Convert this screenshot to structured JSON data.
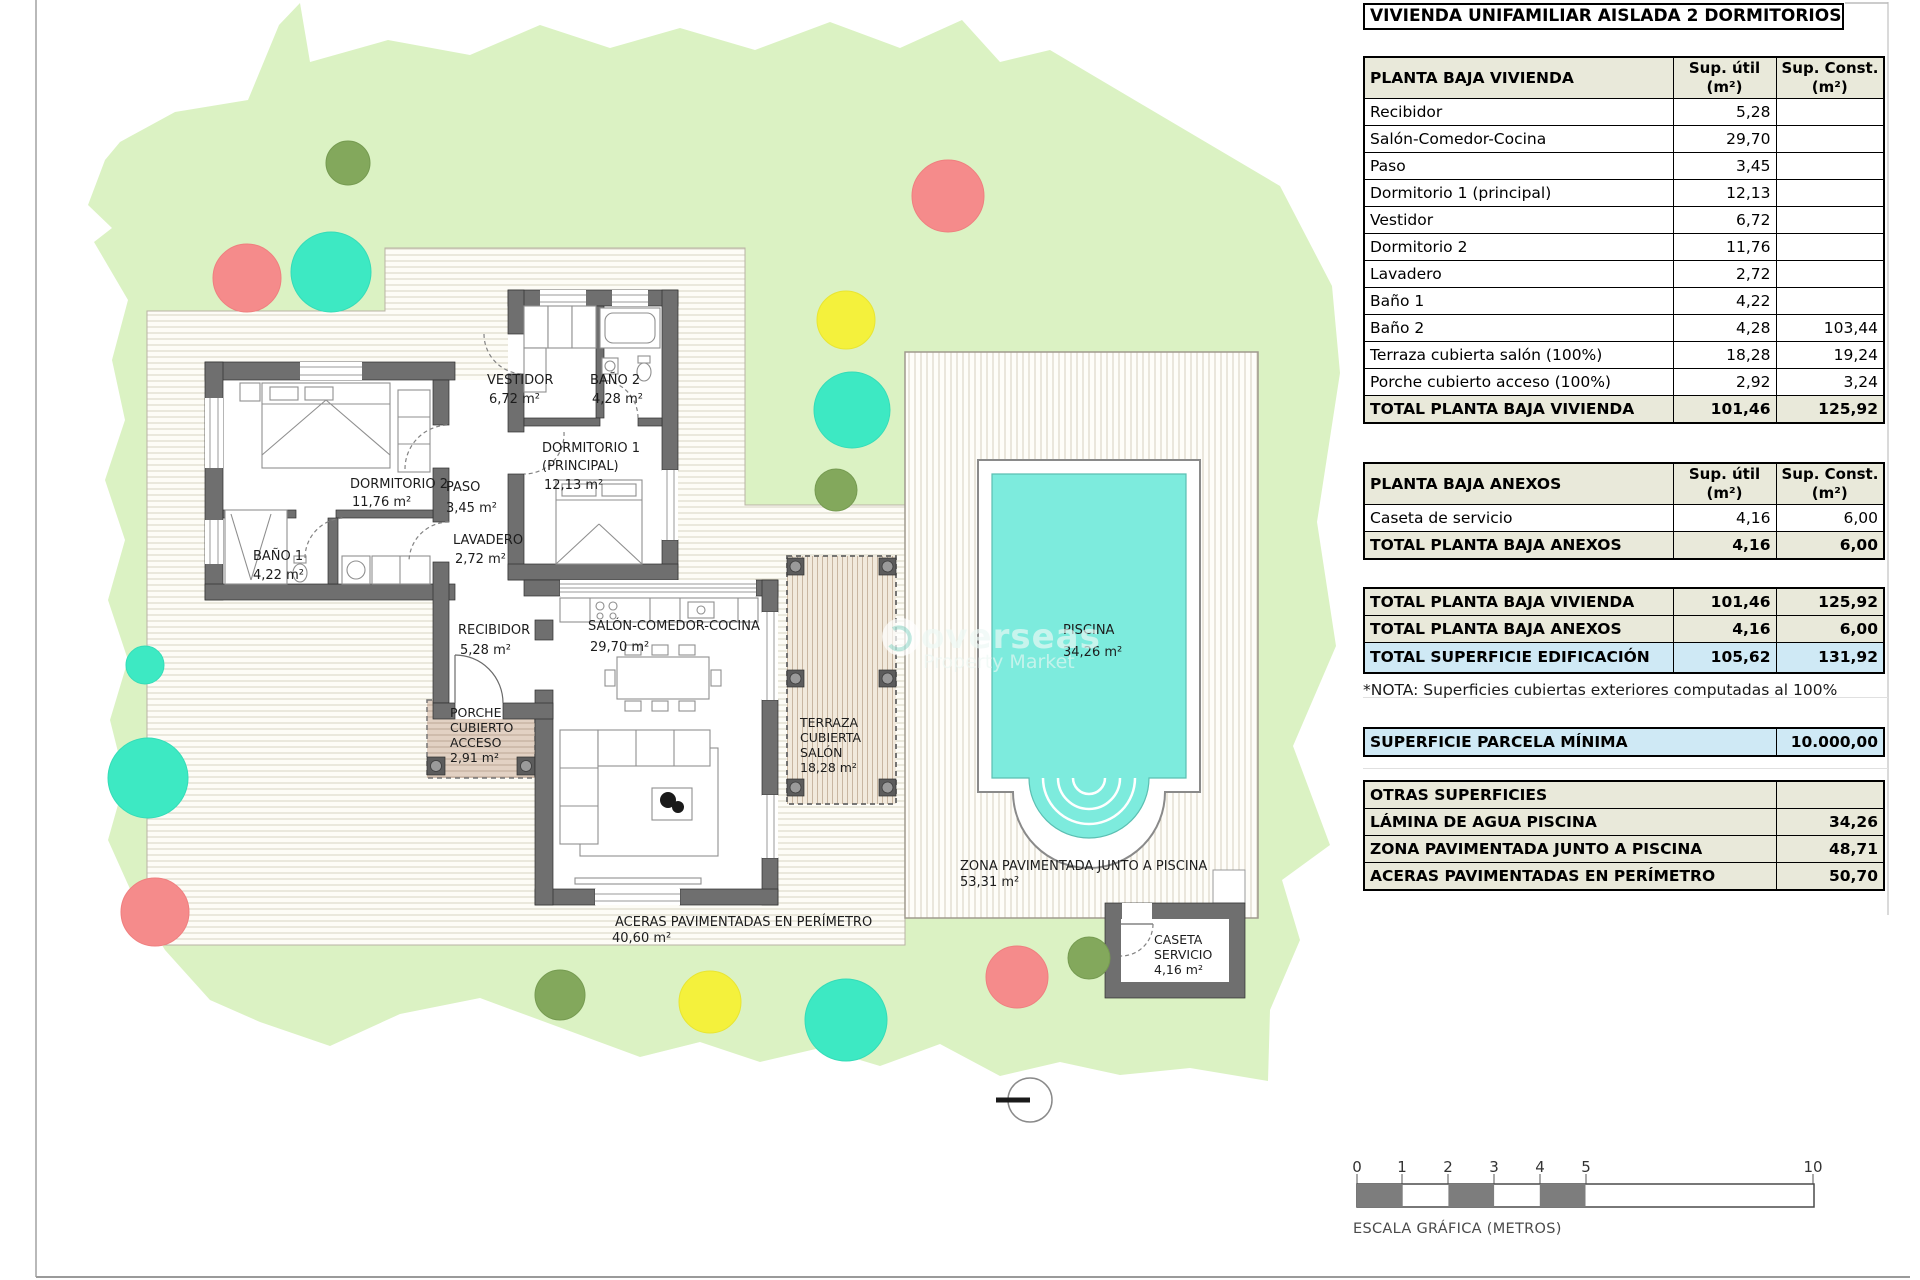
{
  "title": "VIVIENDA UNIFAMILIAR AISLADA 2 DORMITORIOS",
  "columns": {
    "util_1": "Sup. útil",
    "util_2": "(m²)",
    "const_1": "Sup. Const.",
    "const_2": "(m²)"
  },
  "main_table": {
    "header": "PLANTA BAJA VIVIENDA",
    "rows": [
      {
        "label": "Recibidor",
        "util": "5,28",
        "cons": ""
      },
      {
        "label": "Salón-Comedor-Cocina",
        "util": "29,70",
        "cons": ""
      },
      {
        "label": "Paso",
        "util": "3,45",
        "cons": ""
      },
      {
        "label": "Dormitorio 1 (principal)",
        "util": "12,13",
        "cons": ""
      },
      {
        "label": "Vestidor",
        "util": "6,72",
        "cons": ""
      },
      {
        "label": "Dormitorio 2",
        "util": "11,76",
        "cons": ""
      },
      {
        "label": "Lavadero",
        "util": "2,72",
        "cons": ""
      },
      {
        "label": "Baño 1",
        "util": "4,22",
        "cons": ""
      },
      {
        "label": "Baño 2",
        "util": "4,28",
        "cons": "103,44"
      },
      {
        "label": "Terraza cubierta salón (100%)",
        "util": "18,28",
        "cons": "19,24"
      },
      {
        "label": "Porche cubierto acceso (100%)",
        "util": "2,92",
        "cons": "3,24"
      }
    ],
    "total": {
      "label": "TOTAL PLANTA BAJA VIVIENDA",
      "util": "101,46",
      "cons": "125,92"
    }
  },
  "anexos_table": {
    "header": "PLANTA BAJA ANEXOS",
    "rows": [
      {
        "label": "Caseta de servicio",
        "util": "4,16",
        "cons": "6,00"
      }
    ],
    "total": {
      "label": "TOTAL PLANTA BAJA ANEXOS",
      "util": "4,16",
      "cons": "6,00"
    }
  },
  "summary": {
    "rows": [
      {
        "label": "TOTAL PLANTA BAJA VIVIENDA",
        "util": "101,46",
        "cons": "125,92"
      },
      {
        "label": "TOTAL PLANTA BAJA ANEXOS",
        "util": "4,16",
        "cons": "6,00"
      },
      {
        "label": "TOTAL SUPERFICIE EDIFICACIÓN",
        "util": "105,62",
        "cons": "131,92"
      }
    ]
  },
  "nota": "*NOTA: Superficies cubiertas exteriores computadas al 100%",
  "parcela": {
    "label": "SUPERFICIE PARCELA MÍNIMA",
    "value": "10.000,00"
  },
  "otras": {
    "header": "OTRAS SUPERFICIES",
    "rows": [
      {
        "label": "LÁMINA DE AGUA PISCINA",
        "value": "34,26"
      },
      {
        "label": "ZONA PAVIMENTADA JUNTO A PISCINA",
        "value": "48,71"
      },
      {
        "label": "ACERAS PAVIMENTADAS EN PERÍMETRO",
        "value": "50,70"
      }
    ]
  },
  "scale_bar": {
    "ticks": [
      "0",
      "1",
      "2",
      "3",
      "4",
      "5",
      "10"
    ],
    "caption": "ESCALA GRÁFICA (METROS)"
  },
  "watermark": {
    "line1": "overseas",
    "line2": "Property Market"
  },
  "plan": {
    "dormitorio2": {
      "name": "DORMITORIO 2",
      "area": "11,76 m²"
    },
    "bano1": {
      "name": "BAÑO 1",
      "area": "4,22 m²"
    },
    "lavadero": {
      "name": "LAVADERO",
      "area": "2,72 m²"
    },
    "paso": {
      "name": "PASO",
      "area": "3,45 m²"
    },
    "vestidor": {
      "name": "VESTIDOR",
      "area": "6,72 m²"
    },
    "bano2": {
      "name": "BAÑO 2",
      "area": "4,28 m²"
    },
    "dormitorio1": {
      "name": "DORMITORIO 1",
      "name2": "(PRINCIPAL)",
      "area": "12,13 m²"
    },
    "recibidor": {
      "name": "RECIBIDOR",
      "area": "5,28 m²"
    },
    "salon": {
      "name": "SALÓN-COMEDOR-COCINA",
      "area": "29,70 m²"
    },
    "porche": {
      "l1": "PORCHE",
      "l2": "CUBIERTO",
      "l3": "ACCESO",
      "area": "2,91 m²"
    },
    "terraza": {
      "l1": "TERRAZA",
      "l2": "CUBIERTA",
      "l3": "SALÓN",
      "area": "18,28 m²"
    },
    "piscina": {
      "name": "PISCINA",
      "area": "34,26 m²"
    },
    "caseta": {
      "l1": "CASETA",
      "l2": "SERVICIO",
      "area": "4,16 m²"
    },
    "zona": {
      "l1": "ZONA PAVIMENTADA JUNTO A PISCINA",
      "area": "53,31 m²"
    },
    "aceras": {
      "l1": "ACERAS PAVIMENTADAS EN PERÍMETRO",
      "area": "40,60 m²"
    }
  }
}
